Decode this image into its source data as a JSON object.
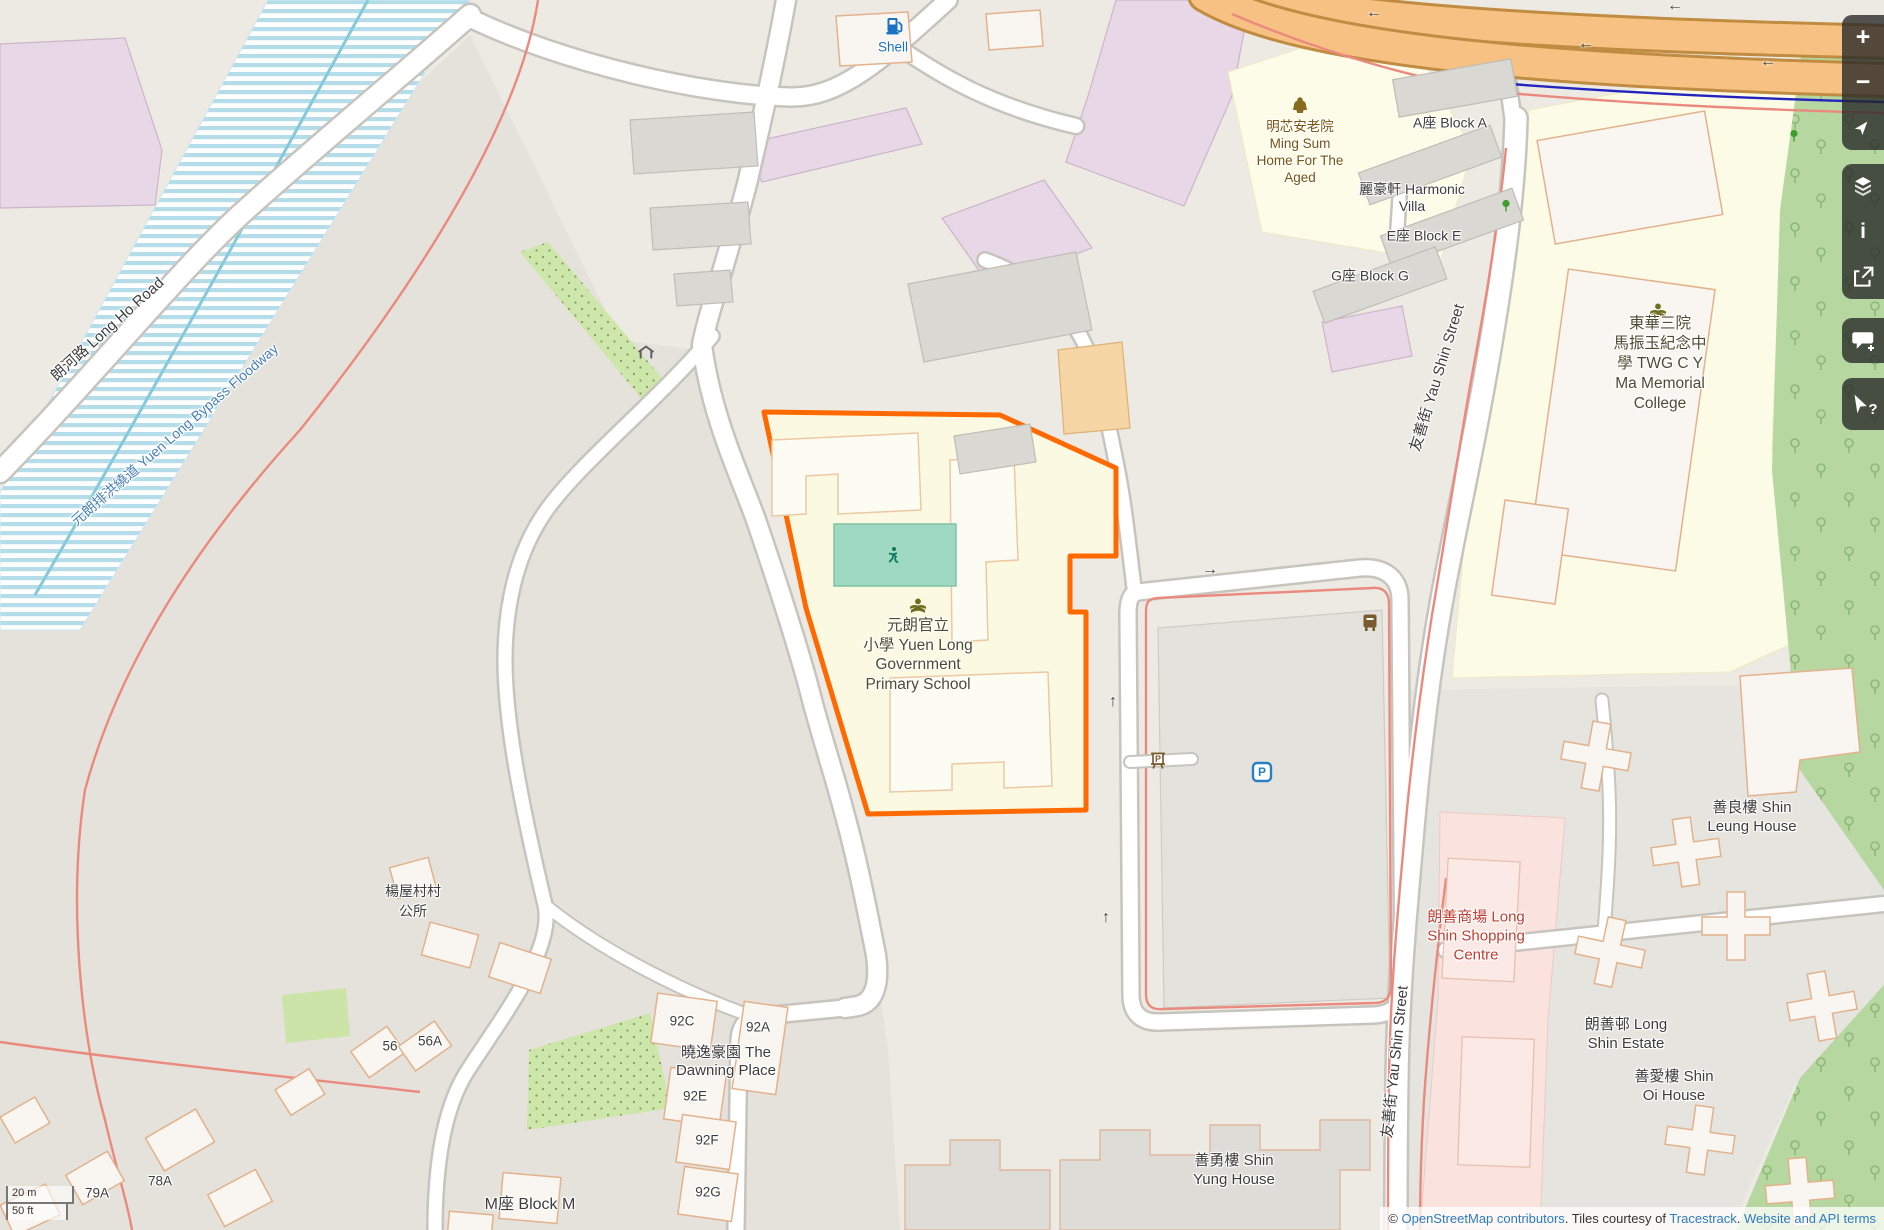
{
  "map": {
    "colors": {
      "selection": "#ff6a00",
      "motorway": "#f6c183",
      "water_stripe": "#b5dde9",
      "school_fill": "#fbf9e1",
      "shopping_label": "#bc3f33"
    },
    "labels": {
      "long_ho_road": "朗河路 Long Ho Road",
      "floodway": "元朗排洪繞道 Yuen Long Bypass Floodway",
      "shell": "Shell",
      "ming_sum": {
        "lines": [
          "明芯安老院",
          "Ming Sum",
          "Home For The",
          "Aged"
        ]
      },
      "block_a": "A座 Block A",
      "harmonic_villa": {
        "lines": [
          "麗豪軒 Harmonic",
          "Villa"
        ]
      },
      "block_e": "E座 Block E",
      "block_g": "G座 Block G",
      "twg_college": {
        "lines": [
          "東華三院",
          "馬振玉紀念中",
          "學 TWG C Y",
          "Ma Memorial",
          "College"
        ]
      },
      "yau_shin_street_upper": "友善街 Yau Shin Street",
      "yau_shin_street_lower": "友善街 Yau Shin Street",
      "school": {
        "lines": [
          "元朗官立",
          "小學 Yuen Long",
          "Government",
          "Primary School"
        ]
      },
      "village_office": {
        "lines": [
          "楊屋村村",
          "公所"
        ]
      },
      "dawning_place": {
        "lines": [
          "曉逸豪園 The",
          "Dawning Place"
        ]
      },
      "block_m": "M座 Block M",
      "shin_leung_house": {
        "lines": [
          "善良樓 Shin",
          "Leung House"
        ]
      },
      "long_shin_shopping": {
        "lines": [
          "朗善商場 Long",
          "Shin Shopping",
          "Centre"
        ]
      },
      "long_shin_estate": {
        "lines": [
          "朗善邨 Long",
          "Shin Estate"
        ]
      },
      "shin_oi_house": {
        "lines": [
          "善愛樓 Shin",
          "Oi House"
        ]
      },
      "shin_yung_house": {
        "lines": [
          "善勇樓 Shin",
          "Yung House"
        ]
      },
      "house_numbers": {
        "n56": "56",
        "n56a": "56A",
        "n78a": "78A",
        "n79a": "79A",
        "n92a": "92A",
        "n92c": "92C",
        "n92e": "92E",
        "n92f": "92F",
        "n92g": "92G"
      }
    },
    "arrows": {
      "left": "←",
      "up": "↑",
      "right": "→"
    },
    "icons": {
      "parking_letter": "P",
      "ticket_letter": "P"
    }
  },
  "controls": {
    "zoom_in": "+",
    "zoom_out": "−",
    "info": "i",
    "query": "?"
  },
  "scale": {
    "metric": "20 m",
    "imperial": "50 ft"
  },
  "attribution": {
    "copyright": "© ",
    "osm": "OpenStreetMap contributors",
    "tiles": ". Tiles courtesy of ",
    "tracestrack": "Tracestrack",
    "period": ". ",
    "terms": "Website and API terms"
  }
}
